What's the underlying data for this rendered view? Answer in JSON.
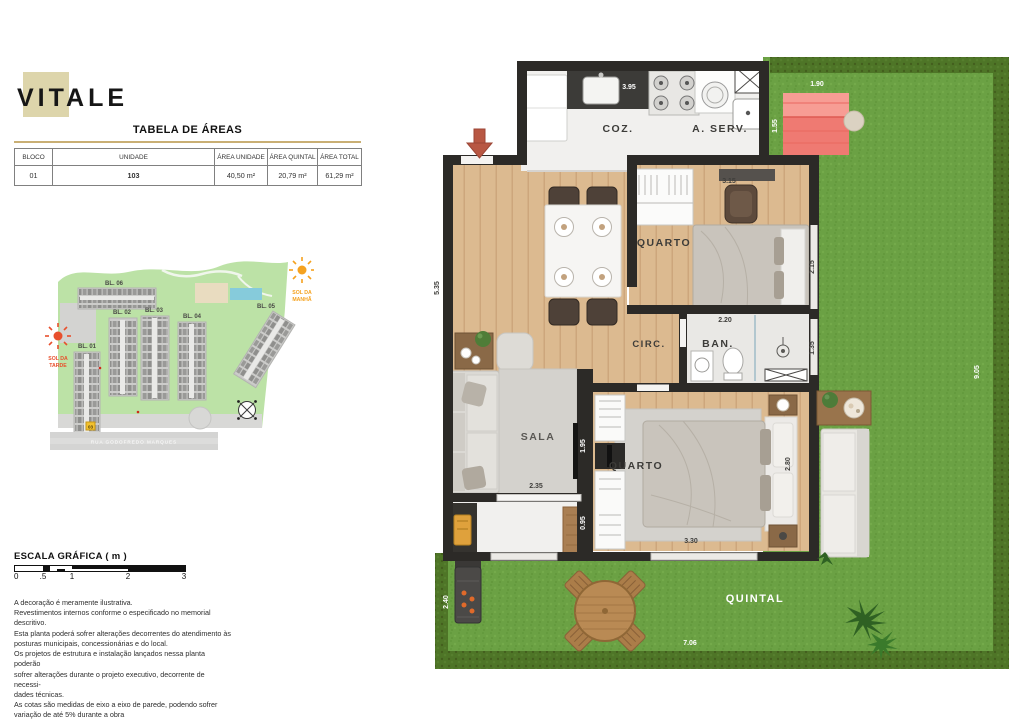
{
  "logo": {
    "text": "VITALE"
  },
  "areas_table": {
    "title": "TABELA DE ÁREAS",
    "headers": [
      "BLOCO",
      "UNIDADE",
      "ÁREA UNIDADE",
      "ÁREA QUINTAL",
      "ÁREA TOTAL"
    ],
    "row": {
      "bloco": "01",
      "unidade": "103",
      "area_unidade": "40,50 m²",
      "area_quintal": "20,79 m²",
      "area_total": "61,29 m²"
    }
  },
  "site_map": {
    "blocks": {
      "b1": "BL. 01",
      "b2": "BL. 02",
      "b3": "BL. 03",
      "b4": "BL. 04",
      "b5": "BL. 05",
      "b6": "BL. 06"
    },
    "sun_morning_l1": "SOL DA",
    "sun_morning_l2": "MANHÃ",
    "sun_afternoon_l1": "SOL DA",
    "sun_afternoon_l2": "TARDE",
    "street": "RUA GODOFREDO MARQUES",
    "highlighted_unit": "03"
  },
  "scale": {
    "title": "ESCALA GRÁFICA ( m )",
    "t0": "0",
    "t1": ".5",
    "t2": "1",
    "t3": "2",
    "t4": "3"
  },
  "disclaimer": {
    "lines": [
      "A decoração é meramente ilustrativa.",
      "Revestimentos internos conforme o especificado no memorial descritivo.",
      "Esta planta poderá sofrer alterações decorrentes do atendimento às",
      "posturas municipais, concessionárias e do local.",
      "Os projetos de estrutura e instalação lançados nessa planta poderão",
      "sofrer alterações durante o projeto executivo, decorrente de necessi-",
      "dades técnicas.",
      "As cotas são medidas de eixo a eixo de parede, podendo sofrer",
      "variação de até 5% durante a obra"
    ]
  },
  "floorplan": {
    "labels": {
      "coz": "COZ.",
      "aserv": "A. SERV.",
      "quarto1": "QUARTO",
      "circ": "CIRC.",
      "ban": "BAN.",
      "sala": "SALA",
      "quarto2": "QUARTO",
      "quintal": "QUINTAL"
    },
    "dims": {
      "d395": "3.95",
      "d190": "1.90",
      "d155": "1.55",
      "d315": "3.15",
      "d215": "2.15",
      "d535": "5.35",
      "d220": "2.20",
      "d135": "1.35",
      "d905": "9.05",
      "d195": "1.95",
      "d235": "2.35",
      "d095": "0.95",
      "d330": "3.30",
      "d280": "2.80",
      "d240": "2.40",
      "d706": "7.06"
    }
  }
}
